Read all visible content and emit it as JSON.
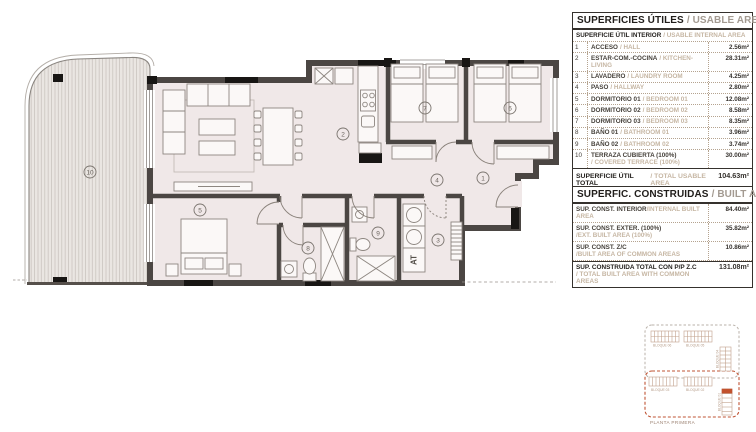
{
  "tables": {
    "usable": {
      "title_es": "SUPERFICIES ÚTILES",
      "title_en": "/ USABLE AREA",
      "subheader_es": "SUPERFICIE ÚTIL INTERIOR",
      "subheader_en": "/ USABLE INTERNAL AREA",
      "rows": [
        {
          "num": "1",
          "name_es": "ACCESO",
          "name_en": "/ HALL",
          "value": "2.56m²"
        },
        {
          "num": "2",
          "name_es": "ESTAR-COM.-COCINA",
          "name_en": "/ KITCHEN-LIVING",
          "value": "28.31m²"
        },
        {
          "num": "3",
          "name_es": "LAVADERO",
          "name_en": "/ LAUNDRY ROOM",
          "value": "4.25m²"
        },
        {
          "num": "4",
          "name_es": "PASO",
          "name_en": "/ HALLWAY",
          "value": "2.80m²"
        },
        {
          "num": "5",
          "name_es": "DORMITORIO 01",
          "name_en": "/ BEDROOM 01",
          "value": "12.08m²"
        },
        {
          "num": "6",
          "name_es": "DORMITORIO 02",
          "name_en": "/ BEDROOM 02",
          "value": "8.58m²"
        },
        {
          "num": "7",
          "name_es": "DORMITORIO 03",
          "name_en": "/ BEDROOM 03",
          "value": "8.35m²"
        },
        {
          "num": "8",
          "name_es": "BAÑO 01",
          "name_en": "/ BATHROOM 01",
          "value": "3.96m²"
        },
        {
          "num": "9",
          "name_es": "BAÑO 02",
          "name_en": "/ BATHROOM 02",
          "value": "3.74m²"
        },
        {
          "num": "10",
          "name_es": "TERRAZA CUBIERTA (100%)",
          "name_en": "/ COVERED TERRACE (100%)",
          "value": "30.00m²",
          "en_block": true
        }
      ],
      "total_es": "SUPERFICIE ÚTIL TOTAL",
      "total_en": "/ TOTAL USABLE AREA",
      "total_value": "104.63m²"
    },
    "built": {
      "title_es": "SUPERFIC. CONSTRUIDAS",
      "title_en": "/ BUILT AREA",
      "rows": [
        {
          "name_es": "SUP. CONST. INTERIOR",
          "name_en": "/INTERNAL BUILT AREA",
          "value": "84.40m²",
          "en_block": false
        },
        {
          "name_es": "SUP. CONST. EXTER. (100%)",
          "name_en": "/EXT. BUILT AREA (100%)",
          "value": "35.82m²",
          "en_block": true
        },
        {
          "name_es": "SUP. CONST. Z/C",
          "name_en": "/BUILT AREA OF COMMON AREAS",
          "value": "10.86m²",
          "en_block": true
        }
      ],
      "total_es": "SUP. CONSTRUIDA TOTAL CON P/P Z.C",
      "total_en": "/ TOTAL BUILT AREA WITH COMMON AREAS",
      "total_value": "131.08m²"
    }
  },
  "plan": {
    "rooms": [
      {
        "number": "1",
        "name": "hall"
      },
      {
        "number": "2",
        "name": "kitchen-living"
      },
      {
        "number": "3",
        "name": "laundry"
      },
      {
        "number": "4",
        "name": "hallway"
      },
      {
        "number": "5",
        "name": "bedroom-01"
      },
      {
        "number": "6",
        "name": "bedroom-02"
      },
      {
        "number": "7",
        "name": "bedroom-03"
      },
      {
        "number": "8",
        "name": "bathroom-01"
      },
      {
        "number": "9",
        "name": "bathroom-02"
      },
      {
        "number": "10",
        "name": "covered-terrace"
      }
    ],
    "at_label": "AT"
  },
  "keyplan": {
    "floor_label": "PLANTA PRIMERA",
    "blocks": [
      "BLOQUE 06",
      "BLOQUE 05",
      "BLOQUE 04",
      "BLOQUE 03",
      "BLOQUE 02",
      "BLOQUE 01"
    ],
    "highlight_color": "#c2512c"
  },
  "colors": {
    "wall": "#4b4643",
    "interior_fill": "#f0e8e8",
    "accent_red": "#bf5434",
    "tan_text": "#c6b6a3",
    "gray_text": "#a39a91"
  }
}
